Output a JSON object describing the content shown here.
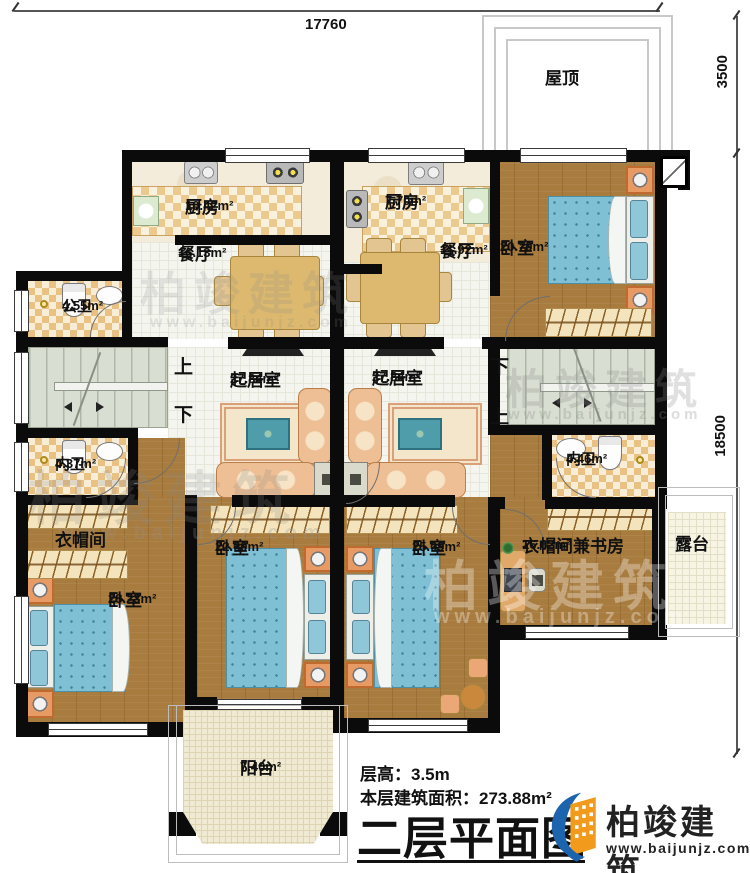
{
  "dimensions": {
    "top": "17760",
    "right_upper": "3500",
    "right_main": "18500"
  },
  "rooms": {
    "roof": {
      "name": "屋顶"
    },
    "kitchen_left": {
      "name": "厨房",
      "area": "10.42m²"
    },
    "kitchen_right": {
      "name": "厨房",
      "area": "7.70m²"
    },
    "dining_left": {
      "name": "餐厅",
      "area": "16.13m²"
    },
    "dining_right": {
      "name": "餐厅",
      "area": "11.92m²"
    },
    "bedroom_top_right": {
      "name": "卧室",
      "area": "20.70m²"
    },
    "bath_public": {
      "name": "公卫",
      "area": "4.55m²"
    },
    "living_left": {
      "name": "起居室",
      "area": "27.84m²"
    },
    "living_right": {
      "name": "起居室",
      "area": "27.84m²"
    },
    "bath_inner_left": {
      "name": "内卫",
      "area": "4.37m²"
    },
    "bath_inner_right": {
      "name": "内卫",
      "area": "4.46m²"
    },
    "cloakroom": {
      "name": "衣帽间"
    },
    "bedroom_bottom_left": {
      "name": "卧室",
      "area": "28.23m²"
    },
    "bedroom_bottom_mid": {
      "name": "卧室",
      "area": "22.60m²"
    },
    "bedroom_bottom_right": {
      "name": "卧室",
      "area": "25.09m²"
    },
    "cloak_study": {
      "name": "衣帽间兼书房",
      "area": "16.62m²"
    },
    "terrace": {
      "name": "露台"
    },
    "balcony": {
      "name": "阳台",
      "area": "7.40m²"
    }
  },
  "stairs": {
    "left": {
      "up": "上",
      "down": "下"
    },
    "right": {
      "down": "下",
      "up": "上"
    }
  },
  "footer": {
    "floor_height": "层高：3.5m",
    "floor_area": "本层建筑面积：273.88m²",
    "title": "二层平面图",
    "brand": "柏竣建筑",
    "url": "www.baijunjz.com"
  },
  "watermark": {
    "brand": "柏竣建筑",
    "url": "www.baijunjz.com"
  },
  "colors": {
    "wall": "#0b0b0b",
    "wood_floor": "#a87b3e",
    "bed_blue": "#7fc0d4",
    "tile": "#e9c183",
    "stairs": "#d8ded1",
    "logo_blue": "#1c64ad",
    "logo_orange": "#f29a1b"
  }
}
